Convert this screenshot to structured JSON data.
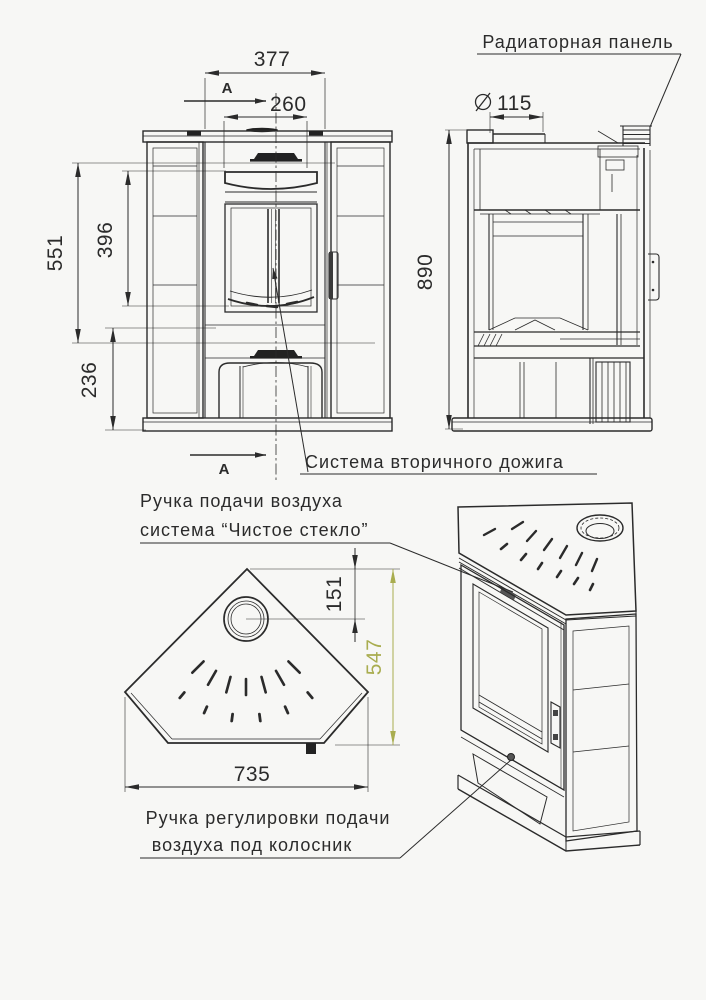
{
  "drawing_title": "Corner stove technical drawing",
  "labels": {
    "radiator_panel": "Радиаторная панель",
    "secondary_burn": "Система вторичного дожига",
    "air_handle_line1": "Ручка подачи воздуха",
    "air_handle_line2": "система “Чистое стекло”",
    "grate_handle_line1": "Ручка регулировки подачи",
    "grate_handle_line2": "воздуха под колосник"
  },
  "dimensions": {
    "front_width": "377",
    "front_opening": "260",
    "height_total": "551",
    "height_glass": "396",
    "height_base": "236",
    "side_height": "890",
    "flue_diameter": "115",
    "top_flue_offset": "151",
    "top_depth": "547",
    "top_width": "735",
    "section_letter": "А"
  },
  "colors": {
    "line": "#2b2b2b",
    "accent_olive": "#a9ad4f",
    "background": "#f7f7f5"
  }
}
